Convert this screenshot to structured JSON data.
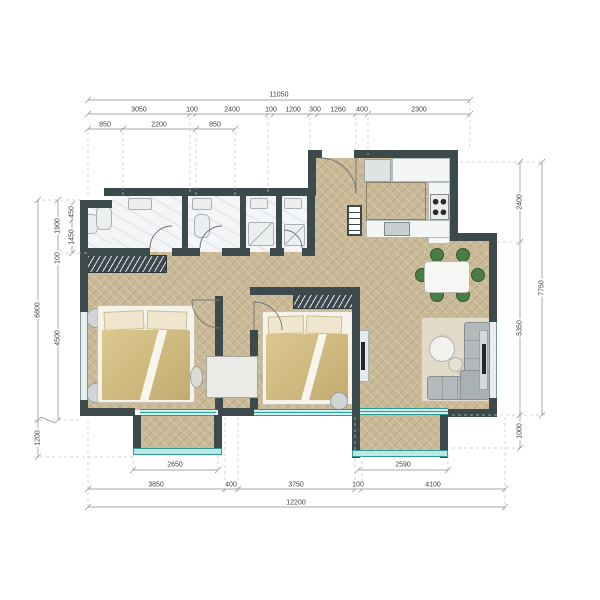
{
  "plan": {
    "kind": "apartment-floor-plan",
    "rooms": [
      "bathrooms",
      "left-bedroom",
      "middle-bedroom",
      "kitchen",
      "dining-area",
      "living-area",
      "left-balcony",
      "right-balcony"
    ]
  },
  "colors": {
    "wall": "#3d4a4c",
    "wood_floor": "#c9b996",
    "bath_floor": "#f4f5f7",
    "balcony_accent": "#2f9a94",
    "balcony_glass": "#cdeeea",
    "chair_green": "#4a7d46",
    "bed_blanket": "#d3bd83",
    "sofa_gray": "#b4babc",
    "dim_text": "#3f3f3f"
  },
  "dims": {
    "top_overall": "11050",
    "top_row2": [
      "3050",
      "100",
      "2400",
      "100",
      "1200",
      "300",
      "1260",
      "400",
      "2300"
    ],
    "top_row3": [
      "850",
      "2200",
      "850"
    ],
    "left_outer": "6800",
    "left_mid": [
      "1900",
      "100",
      "4500"
    ],
    "left_inner": [
      "450",
      "1450"
    ],
    "left_bottom": "1200",
    "right_inner": [
      "2400",
      "5350",
      "1000"
    ],
    "right_outer": "7750",
    "bottom_balcony_left": "2650",
    "bottom_balcony_right": "2590",
    "bottom_row2": [
      "3850",
      "400",
      "3750",
      "100",
      "4100"
    ],
    "bottom_overall": "12200"
  }
}
